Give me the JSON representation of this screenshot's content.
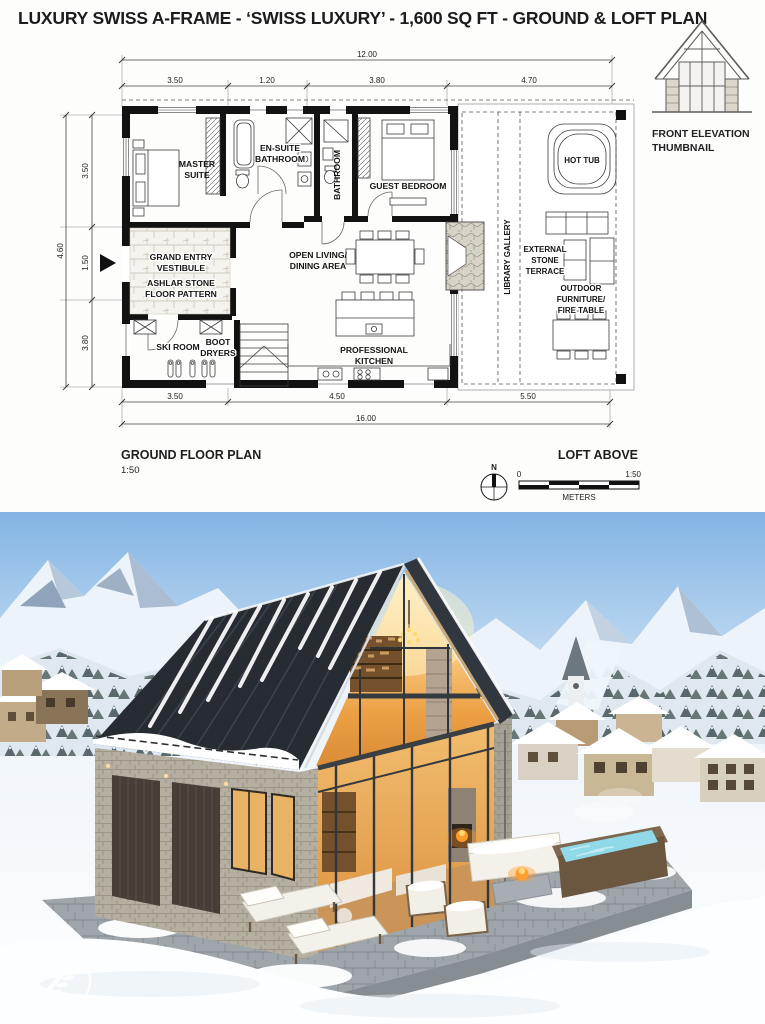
{
  "poster": {
    "title": "LUXURY SWISS A-FRAME - ‘SWISS LUXURY’ - 1,600 SQ FT - GROUND & LOFT PLAN"
  },
  "thumbnail": {
    "icon": "a-frame-elevation-icon",
    "caption": [
      "FRONT ELEVATION",
      "THUMBNAIL"
    ]
  },
  "floor_plan": {
    "rooms": {
      "master": [
        "MASTER",
        "SUITE"
      ],
      "ensuite": [
        "EN-SUITE",
        "BATHROOM"
      ],
      "bathroom": "BATHROOM",
      "guest": "GUEST BEDROOM",
      "entry": [
        "GRAND ENTRY",
        "VESTIBULE"
      ],
      "ashlar": [
        "ASHLAR STONE",
        "FLOOR PATTERN"
      ],
      "ski": "SKI ROOM",
      "boot": [
        "BOOT",
        "DRYERS"
      ],
      "living": [
        "OPEN LIVING/",
        "DINING AREA"
      ],
      "kitchen": [
        "PROFESSIONAL",
        "KITCHEN"
      ],
      "library": "LIBRARY GALLERY",
      "hot_tub": "HOT TUB",
      "terrace": [
        "EXTERNAL",
        "STONE",
        "TERRACE"
      ],
      "outdoor": [
        "OUTDOOR",
        "FURNITURE/",
        "FIRE TABLE"
      ]
    },
    "dimensions": {
      "top": {
        "total": "12.00",
        "segments": [
          "3.50",
          "1.20",
          "3.80",
          "4.70"
        ]
      },
      "left": {
        "total": "4.60",
        "segments": [
          "3.50",
          "1.50",
          "3.80"
        ]
      },
      "bottom": {
        "total": "16.00",
        "segments": [
          "3.50",
          "4.50",
          "5.50"
        ]
      }
    },
    "footer": {
      "plan_title": "GROUND FLOOR PLAN",
      "plan_scale": "1:50",
      "loft_note": "LOFT ABOVE",
      "compass_north": "N",
      "scale_zero": "0",
      "scale_ratio": "1:50",
      "scale_units": "METERS"
    }
  },
  "photo": {
    "watermark": "skyryedesign.com",
    "logo_icon": "leaf-sprig"
  },
  "colors": {
    "roof": "#262c32",
    "glass_glow": "#eda84f",
    "sky": "#85b5e3",
    "stone_wall": "#b5afa2",
    "plan_line": "#111111",
    "watermark": "#ffffff"
  }
}
